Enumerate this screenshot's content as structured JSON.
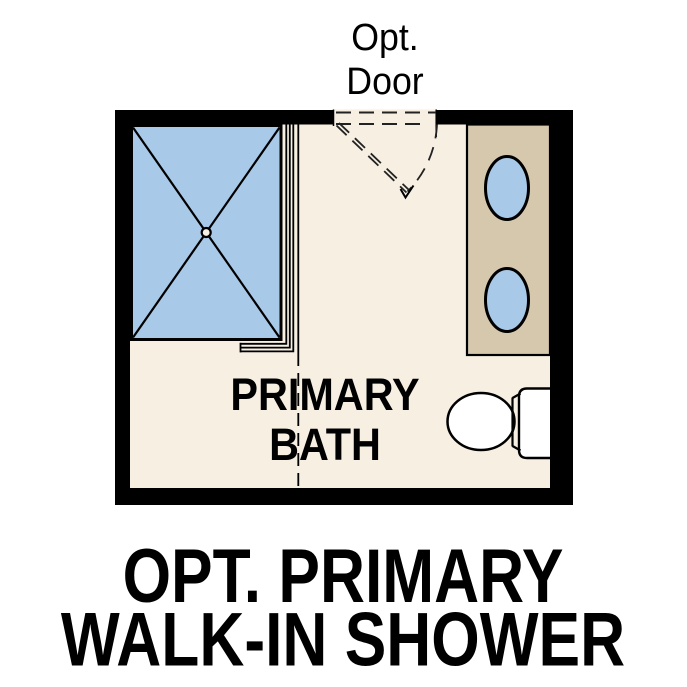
{
  "door_label": {
    "line1": "Opt.",
    "line2": "Door"
  },
  "room_label": {
    "line1": "PRIMARY",
    "line2": "BATH"
  },
  "caption": {
    "line1": "OPT. PRIMARY",
    "line2": "WALK-IN SHOWER"
  },
  "colors": {
    "wall": "#000000",
    "floor": "#f6efe2",
    "fixture_blue": "#a9c9e9",
    "vanity_tan": "#d5c8ad",
    "text": "#000000"
  }
}
